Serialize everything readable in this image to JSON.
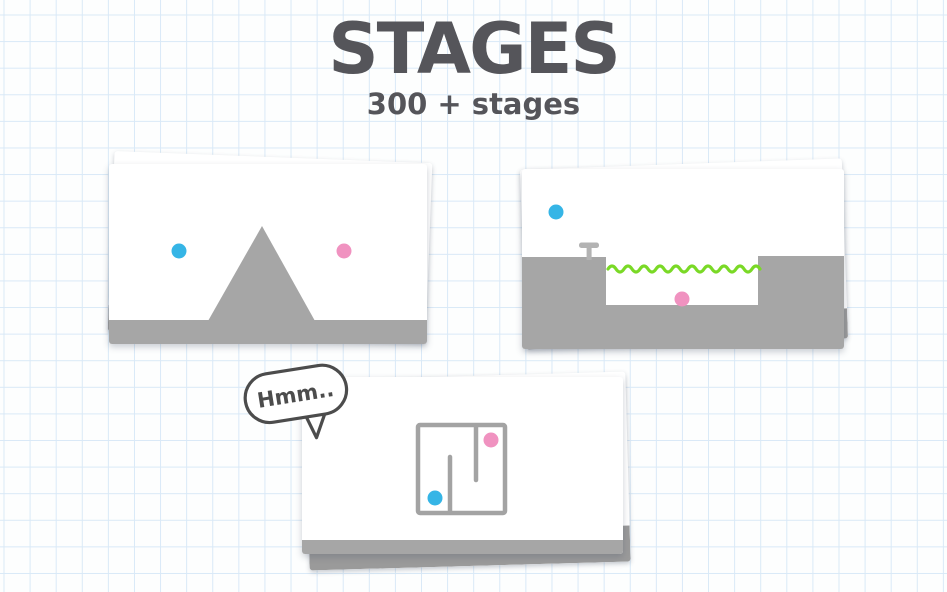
{
  "header": {
    "title": "STAGES",
    "subtitle": "300 + stages"
  },
  "bubble": {
    "text": "Hmm.."
  },
  "stages": [
    {
      "id": "mountain-stage",
      "description": "blue ball and pink ball separated by a gray triangular mountain on a flat gray floor"
    },
    {
      "id": "water-pit-stage",
      "description": "blue ball above a ledge with a small T pin; pink ball at the bottom of a pit under a green wavy water line"
    },
    {
      "id": "maze-stage",
      "description": "blue ball and pink ball inside a square gray maze; thinking speech bubble saying Hmm.."
    }
  ],
  "colors": {
    "paper": "#fdfefe",
    "grid_line": "#d9e9f7",
    "ink": "#55555a",
    "bubble_ink": "#4c4c4c",
    "card_white": "#ffffff",
    "terrain_gray": "#a6a6a6",
    "back_floor_gray": "#9a9a9a",
    "pin_gray": "#b3b3b3",
    "maze_gray": "#a3a3a3",
    "ball_blue": "#35b5e6",
    "ball_pink": "#f092c0",
    "water_green": "#7ad926"
  }
}
